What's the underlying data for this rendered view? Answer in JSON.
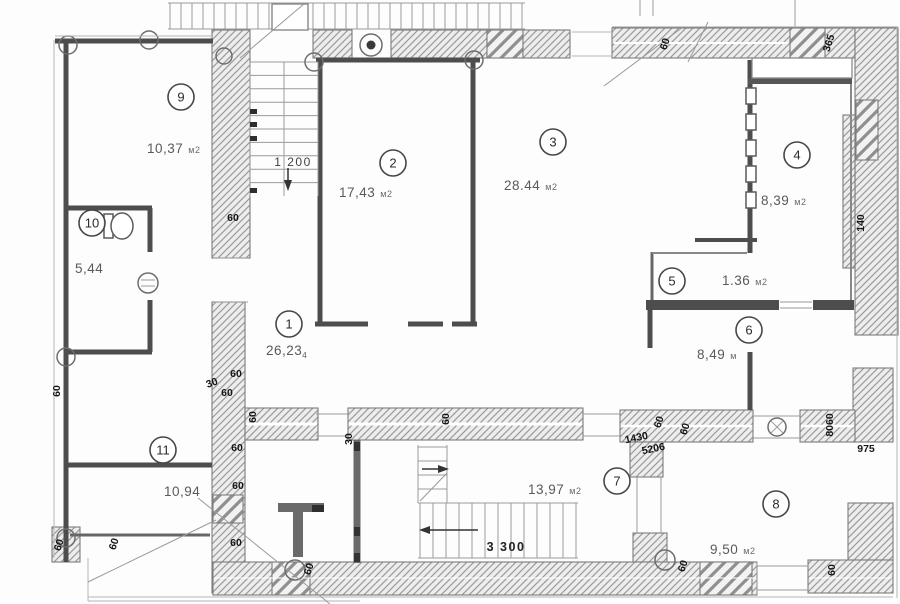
{
  "plan": {
    "unit_default": "м2",
    "colors": {
      "hatch_line": "#9b9b9b",
      "partition": "#4d4d4d",
      "dim_text": "#161616",
      "area_text": "#5a5a5a"
    },
    "rooms": [
      {
        "number": "9",
        "area": "10,37",
        "unit": "м2",
        "cx": 181,
        "cy": 97,
        "ax": 147,
        "ay": 153
      },
      {
        "number": "10",
        "area": "5,44",
        "unit": "",
        "cx": 92,
        "cy": 223,
        "ax": 75,
        "ay": 273
      },
      {
        "number": "2",
        "area": "17,43",
        "unit": "м2",
        "cx": 393,
        "cy": 163,
        "ax": 339,
        "ay": 197
      },
      {
        "number": "3",
        "area": "28.44",
        "unit": "м2",
        "cx": 553,
        "cy": 142,
        "ax": 504,
        "ay": 190
      },
      {
        "number": "4",
        "area": "8,39",
        "unit": "м2",
        "cx": 797,
        "cy": 155,
        "ax": 761,
        "ay": 205
      },
      {
        "number": "5",
        "area": "1.36",
        "unit": "м2",
        "cx": 672,
        "cy": 281,
        "ax": 722,
        "ay": 285
      },
      {
        "number": "6",
        "area": "8,49",
        "unit": "м",
        "cx": 749,
        "cy": 330,
        "ax": 697,
        "ay": 359
      },
      {
        "number": "1",
        "area": "26,23",
        "unit": "",
        "sub": "4",
        "cx": 289,
        "cy": 324,
        "ax": 266,
        "ay": 355
      },
      {
        "number": "11",
        "area": "10,94",
        "unit": "",
        "cx": 163,
        "cy": 450,
        "ax": 164,
        "ay": 496
      },
      {
        "number": "7",
        "area": "13,97",
        "unit": "м2",
        "cx": 617,
        "cy": 481,
        "ax": 528,
        "ay": 494
      },
      {
        "number": "8",
        "area": "9,50",
        "unit": "м2",
        "cx": 776,
        "cy": 504,
        "ax": 710,
        "ay": 554
      }
    ],
    "dimensions": [
      {
        "text": "60",
        "x": 233,
        "y": 221,
        "rot": 0
      },
      {
        "text": "60",
        "x": 668,
        "y": 45,
        "rot": -72
      },
      {
        "text": "365",
        "x": 832,
        "y": 44,
        "rot": -72
      },
      {
        "text": "140",
        "x": 864,
        "y": 223,
        "rot": -90
      },
      {
        "text": "60",
        "x": 60,
        "y": 391,
        "rot": -90
      },
      {
        "text": "60",
        "x": 62,
        "y": 546,
        "rot": -72
      },
      {
        "text": "60",
        "x": 236,
        "y": 377,
        "rot": 0
      },
      {
        "text": "30",
        "x": 213,
        "y": 386,
        "rot": -20
      },
      {
        "text": "60",
        "x": 227,
        "y": 396,
        "rot": 0
      },
      {
        "text": "60",
        "x": 256,
        "y": 417,
        "rot": -90
      },
      {
        "text": "60",
        "x": 237,
        "y": 451,
        "rot": 0
      },
      {
        "text": "60",
        "x": 238,
        "y": 489,
        "rot": 0
      },
      {
        "text": "60",
        "x": 117,
        "y": 545,
        "rot": -72
      },
      {
        "text": "60",
        "x": 236,
        "y": 546,
        "rot": 0
      },
      {
        "text": "60",
        "x": 312,
        "y": 570,
        "rot": -72
      },
      {
        "text": "30",
        "x": 352,
        "y": 439,
        "rot": -90
      },
      {
        "text": "60",
        "x": 449,
        "y": 419,
        "rot": -90
      },
      {
        "text": "60",
        "x": 662,
        "y": 423,
        "rot": -72
      },
      {
        "text": "60",
        "x": 688,
        "y": 430,
        "rot": -72
      },
      {
        "text": "1430",
        "x": 637,
        "y": 441,
        "rot": -12
      },
      {
        "text": "5206",
        "x": 654,
        "y": 452,
        "rot": -12
      },
      {
        "text": "8060",
        "x": 833,
        "y": 425,
        "rot": -90
      },
      {
        "text": "975",
        "x": 866,
        "y": 452,
        "rot": 0
      },
      {
        "text": "60",
        "x": 686,
        "y": 567,
        "rot": -72
      },
      {
        "text": "60",
        "x": 835,
        "y": 570,
        "rot": -90
      }
    ],
    "scale_labels": [
      {
        "text": "1 200",
        "x": 293,
        "y": 166,
        "bold": false
      },
      {
        "text": "3 300",
        "x": 506,
        "y": 551,
        "bold": true
      }
    ]
  }
}
